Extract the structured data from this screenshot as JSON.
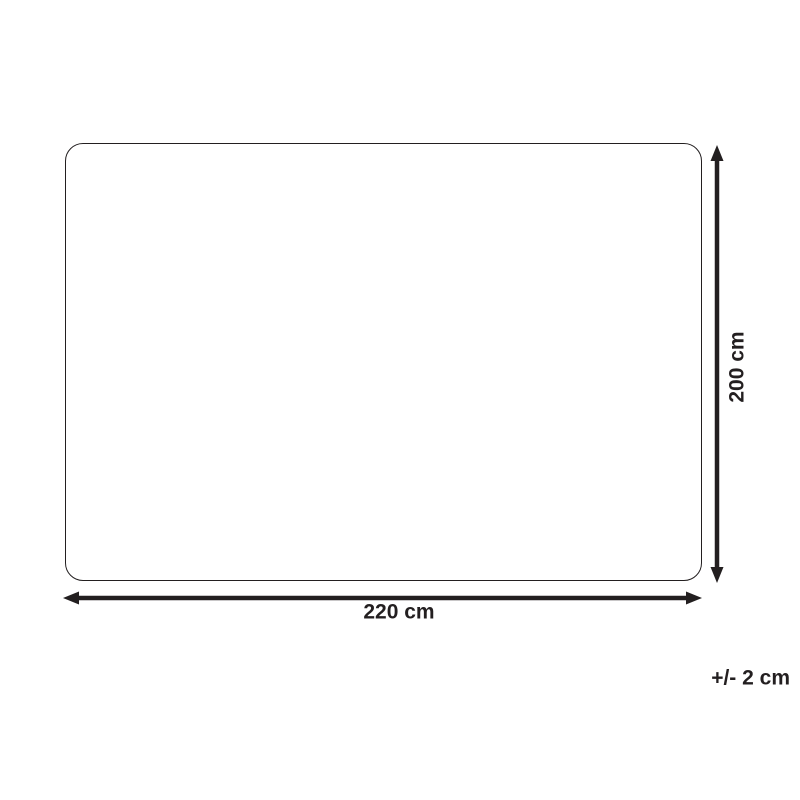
{
  "colors": {
    "ink": "#231f20",
    "background": "#ffffff"
  },
  "diagram": {
    "shape": "rounded-rectangle",
    "height_dimension": {
      "label": "200 cm"
    },
    "width_dimension": {
      "label": "220 cm"
    },
    "tolerance": {
      "label": "+/- 2 cm"
    }
  }
}
